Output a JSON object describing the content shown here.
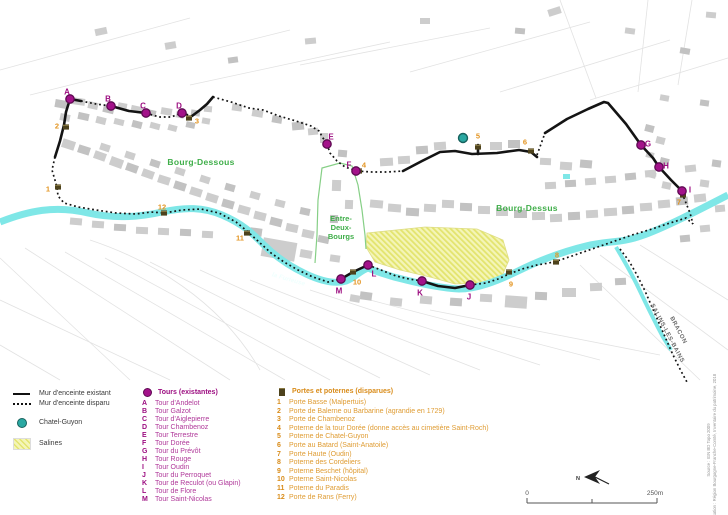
{
  "colors": {
    "tower_magenta": "#a3128a",
    "tower_magenta_dark": "#5e0a52",
    "gate_orange": "#e39420",
    "district_green": "#3fae49",
    "area_green_outline": "#86cf86",
    "chatel_teal": "#2aa8a2",
    "river_cyan": "#7fe7e7",
    "salines_yellow": "#f4f5b8",
    "salines_hatch": "#e3e46e",
    "wall_black": "#141414",
    "building_gray": "#cdcdcd"
  },
  "legend": {
    "wall_existing": "Mur d'enceinte existant",
    "wall_gone": "Mur d'enceinte disparu",
    "chatel": "Chatel-Guyon",
    "salines": "Salines"
  },
  "map": {
    "labels": [
      {
        "text": "Bourg-Dessous",
        "x": 201,
        "y": 165,
        "rot": 0,
        "cls": "district"
      },
      {
        "text": "Bourg-Dessus",
        "x": 527,
        "y": 211,
        "rot": 0,
        "cls": "district"
      },
      {
        "text": "Entre-",
        "x": 341,
        "y": 221,
        "rot": 0,
        "cls": "edb"
      },
      {
        "text": "Deux-",
        "x": 341,
        "y": 230,
        "rot": 0,
        "cls": "edb"
      },
      {
        "text": "Bourgs",
        "x": 341,
        "y": 239,
        "rot": 0,
        "cls": "edb"
      },
      {
        "text": "la Furieuse",
        "x": 288,
        "y": 281,
        "rot": 16,
        "cls": "river-name"
      },
      {
        "text": "BRACON",
        "x": 677,
        "y": 331,
        "rot": 62,
        "cls": "road-name"
      },
      {
        "text": "SALINS-LES-BAINS",
        "x": 666,
        "y": 334,
        "rot": 62,
        "cls": "road-name"
      }
    ],
    "towers": {
      "symbol_label": "Tours (existantes)",
      "items": [
        {
          "id": "A",
          "name": "Tour d'Andelot",
          "x": 70,
          "y": 99,
          "lx": 67,
          "ly": 92
        },
        {
          "id": "B",
          "name": "Tour Galzot",
          "x": 111,
          "y": 106,
          "lx": 108,
          "ly": 99
        },
        {
          "id": "C",
          "name": "Tour d'Aiglepierre",
          "x": 146,
          "y": 113,
          "lx": 143,
          "ly": 106
        },
        {
          "id": "D",
          "name": "Tour Chambenoz",
          "x": 182,
          "y": 113,
          "lx": 179,
          "ly": 106
        },
        {
          "id": "E",
          "name": "Tour Terrestre",
          "x": 327,
          "y": 144,
          "lx": 331,
          "ly": 137
        },
        {
          "id": "F",
          "name": "Tour Dorée",
          "x": 356,
          "y": 171,
          "lx": 349,
          "ly": 165
        },
        {
          "id": "G",
          "name": "Tour du Prévôt",
          "x": 641,
          "y": 145,
          "lx": 648,
          "ly": 144
        },
        {
          "id": "H",
          "name": "Tour Rouge",
          "x": 659,
          "y": 167,
          "lx": 666,
          "ly": 166
        },
        {
          "id": "I",
          "name": "Tour Oudin",
          "x": 682,
          "y": 191,
          "lx": 690,
          "ly": 190
        },
        {
          "id": "J",
          "name": "Tour du Perroquet",
          "x": 470,
          "y": 285,
          "lx": 469,
          "ly": 297
        },
        {
          "id": "K",
          "name": "Tour de Reculot (ou Glapin)",
          "x": 422,
          "y": 281,
          "lx": 420,
          "ly": 293
        },
        {
          "id": "L",
          "name": "Tour de Flore",
          "x": 368,
          "y": 265,
          "lx": 374,
          "ly": 274
        },
        {
          "id": "M",
          "name": "Tour Saint-Nicolas",
          "x": 341,
          "y": 279,
          "lx": 339,
          "ly": 291
        }
      ]
    },
    "gates": {
      "symbol_label": "Portes et poternes (disparues)",
      "items": [
        {
          "id": "1",
          "name": "Porte Basse (Malpertuis)",
          "x": 58,
          "y": 187,
          "lx": 48,
          "ly": 189
        },
        {
          "id": "2",
          "name": "Porte de Balerne ou Barbarine (agrandie en 1729)",
          "x": 66,
          "y": 127,
          "lx": 57,
          "ly": 126
        },
        {
          "id": "3",
          "name": "Porte de Chambenoz",
          "x": 189,
          "y": 118,
          "lx": 197,
          "ly": 121
        },
        {
          "id": "4",
          "name": "Poterne de la tour Dorée (donne accès au cimetière Saint-Roch)",
          "x": 359,
          "y": 171,
          "lx": 364,
          "ly": 165
        },
        {
          "id": "5",
          "name": "Poterne de Chatel-Guyon",
          "x": 478,
          "y": 147,
          "lx": 478,
          "ly": 136
        },
        {
          "id": "6",
          "name": "Porte au Batard (Saint-Anatoile)",
          "x": 531,
          "y": 151,
          "lx": 525,
          "ly": 142
        },
        {
          "id": "7",
          "name": "Porte Haute (Oudin)",
          "x": 683,
          "y": 195,
          "lx": 679,
          "ly": 202
        },
        {
          "id": "8",
          "name": "Poterne des Cordeliers",
          "x": 556,
          "y": 262,
          "lx": 557,
          "ly": 255
        },
        {
          "id": "9",
          "name": "Poterne Beschet (hôpital)",
          "x": 509,
          "y": 272,
          "lx": 511,
          "ly": 284
        },
        {
          "id": "10",
          "name": "Poterne Saint-Nicolas",
          "x": 353,
          "y": 272,
          "lx": 357,
          "ly": 282
        },
        {
          "id": "11",
          "name": "Poterne du Paradis",
          "x": 247,
          "y": 233,
          "lx": 240,
          "ly": 238
        },
        {
          "id": "12",
          "name": "Porte de Rans (Ferry)",
          "x": 164,
          "y": 213,
          "lx": 162,
          "ly": 207
        }
      ]
    },
    "chatel_guyon_dot": {
      "x": 463,
      "y": 138
    },
    "scale": {
      "start": "0",
      "end": "250m"
    },
    "north_label": "N",
    "credits": [
      "Source : IGN BD Topo 2009",
      "Réalisation : Région Bourgogne-Franche-Comté, Inventaire du patrimoine, 2018"
    ]
  }
}
